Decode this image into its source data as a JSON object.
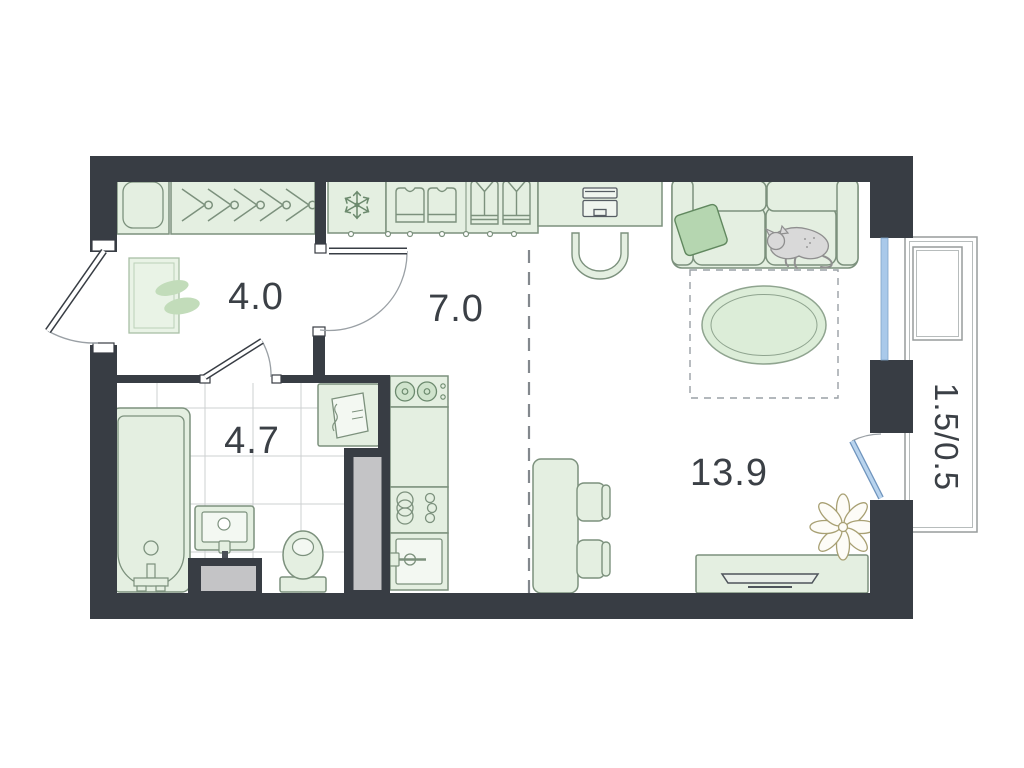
{
  "plan": {
    "type": "apartment-floor-plan",
    "room_labels": {
      "hallway": "4.0",
      "kitchen_dining": "7.0",
      "bathroom": "4.7",
      "living_area": "13.9",
      "balcony": "1.5/0.5"
    },
    "colors": {
      "wall": "#383d44",
      "furniture_fill": "#e4efe1",
      "furniture_stroke": "#7c917d",
      "accent_green": "#b5d6b0",
      "window_blue": "#a9c9ea",
      "balcony_door_blue": "#b9d4ee",
      "shaft_gray": "#c4c4c6",
      "tile_line": "#cdd0d2",
      "label_text": "#3b4046",
      "background": "#ffffff"
    },
    "icons": [
      "entry-cabinet",
      "hanger-rail",
      "snowflake-freezer",
      "wardrobe-shirts",
      "desk-laptop",
      "desk-chair",
      "sofa",
      "pillow",
      "sleeping-cat",
      "oval-rug",
      "rug-zone-dashed",
      "dining-table",
      "dining-chairs",
      "tv-stand",
      "tv",
      "plant-flower",
      "stove-burners",
      "kitchen-sink",
      "dish-rack",
      "bathtub",
      "washbasin",
      "toilet",
      "washing-machine",
      "entrance-door",
      "interior-door",
      "bathroom-door",
      "window",
      "balcony-door",
      "hall-rug"
    ]
  }
}
